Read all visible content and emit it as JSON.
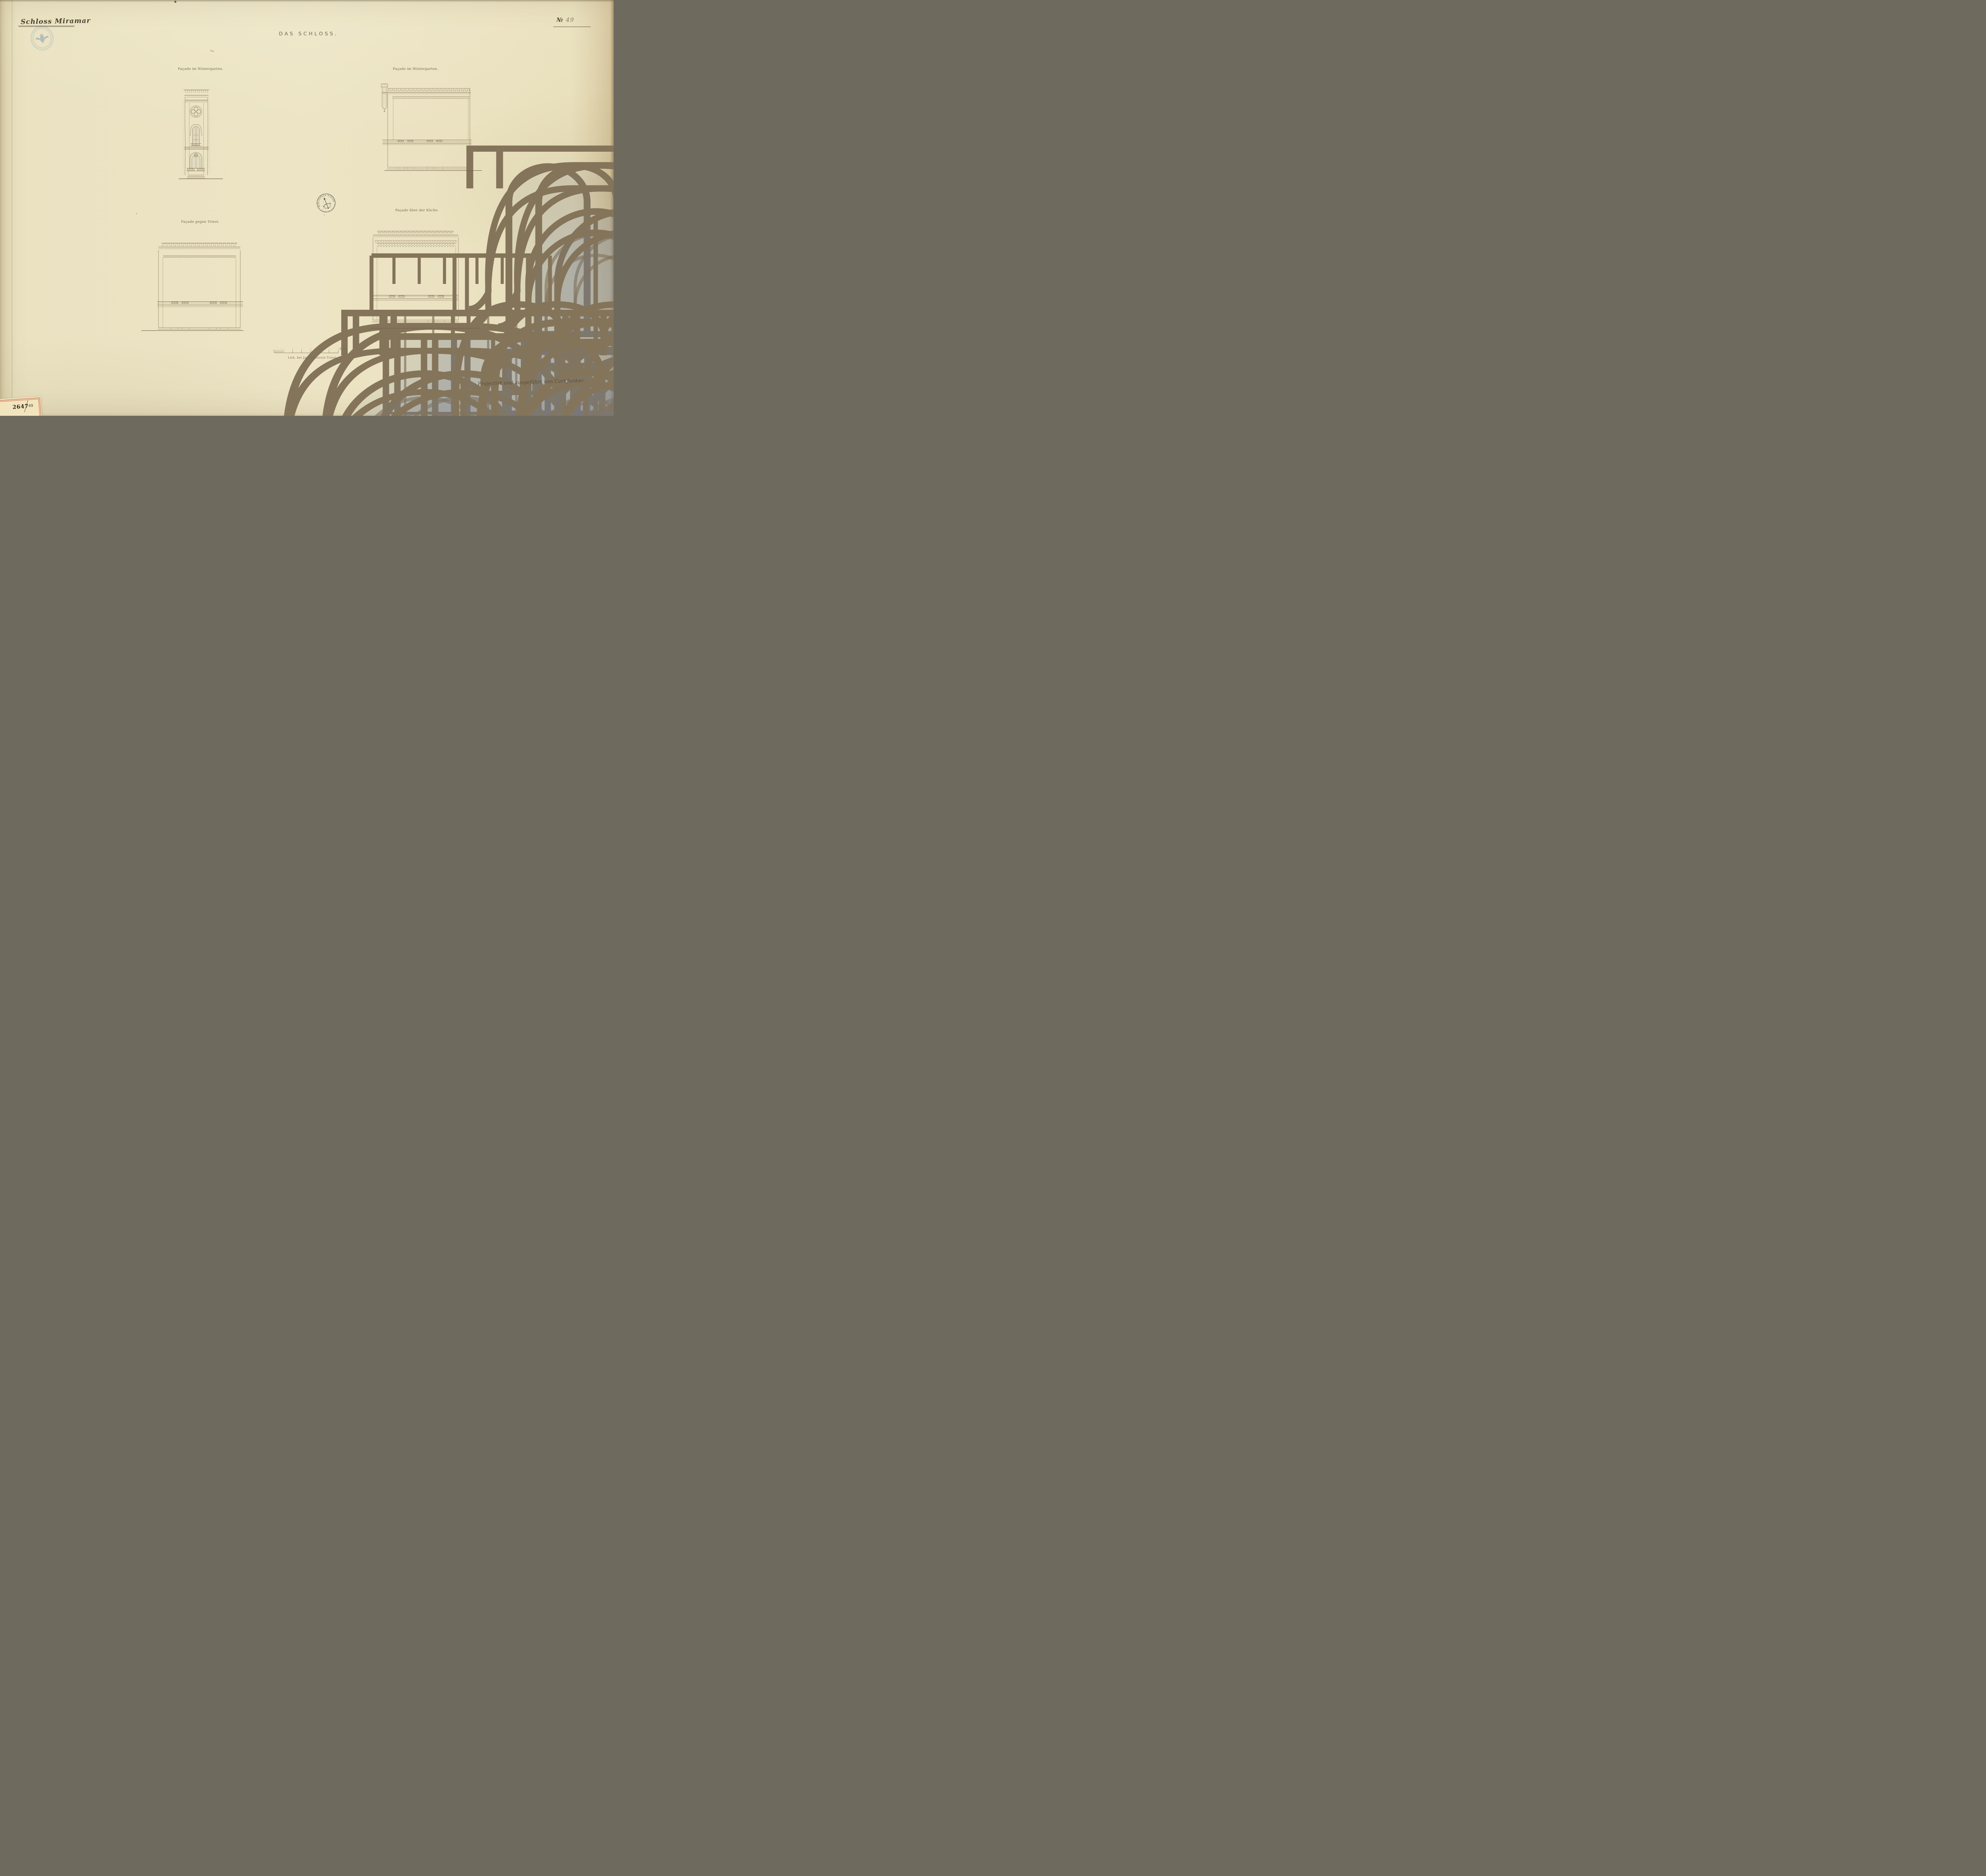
{
  "header": {
    "series_title": "Schloss Miramar",
    "plate_no_symbol": "№",
    "plate_no_value": "49",
    "main_title": "DAS SCHLOSS."
  },
  "drawings": {
    "tower": {
      "label": "Façade im Wintergarten."
    },
    "top_right": {
      "label": "Façade im Wintergarten."
    },
    "bottom_left": {
      "label": "Façade gegen Triest."
    },
    "bottom_right": {
      "label": "Façade über der Küche."
    }
  },
  "scale_bar": {
    "unit_label": "W.Kl"
  },
  "footer": {
    "lithographer": "Lith. bei Jos: Matovich Triest.",
    "credit": "Projectirt und ausgeführt von Carl Junker."
  },
  "stamps": {
    "library": {
      "arc_text": "BIBLIOTECA CIVICA",
      "bottom_text": "TRIESTE"
    }
  },
  "inventory_label": {
    "number": "2647",
    "year_suffix": "49"
  }
}
